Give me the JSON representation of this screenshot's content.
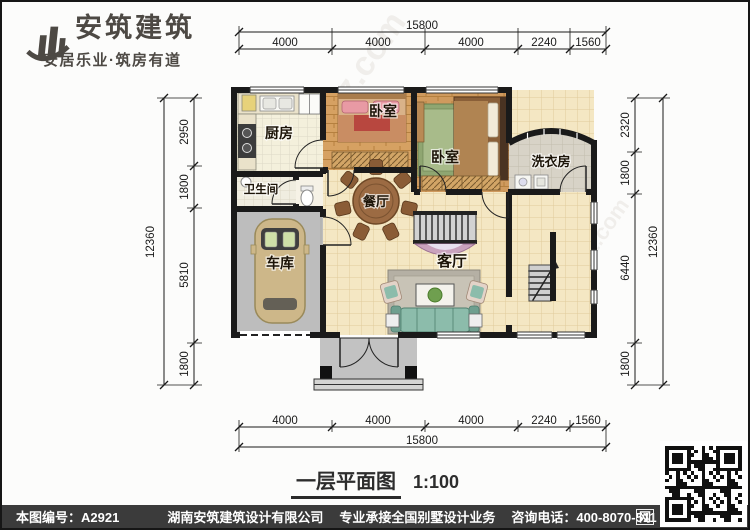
{
  "brand": {
    "logo_name": "安筑建筑",
    "tagline": "安居乐业·筑房有道"
  },
  "title": {
    "text": "一层平面图",
    "scale": "1:100"
  },
  "rooms": {
    "kitchen": "厨房",
    "bedroom_top": "卧室",
    "bedroom_right": "卧室",
    "laundry": "洗衣房",
    "bathroom": "卫生间",
    "dining": "餐厅",
    "garage": "车库",
    "living": "客厅"
  },
  "dimensions": {
    "top": {
      "total": "15800",
      "segments": [
        "4000",
        "4000",
        "4000",
        "2240",
        "1560"
      ]
    },
    "bottom": {
      "total": "15800",
      "segments": [
        "4000",
        "4000",
        "4000",
        "2240",
        "1560"
      ]
    },
    "left": {
      "total": "12360",
      "segments": [
        "2950",
        "1800",
        "5810",
        "1800"
      ]
    },
    "right": {
      "total": "12360",
      "segments": [
        "2320",
        "1800",
        "6440",
        "1800"
      ]
    }
  },
  "footer": {
    "drawing_no": "本图编号：A2921",
    "company": "湖南安筑建筑设计有限公司",
    "service": "专业承接全国别墅设计业务",
    "phone": "咨询电话：400-8070-511",
    "web_char": "网"
  },
  "watermark": {
    "site": "hnazjz.com",
    "brand": "安筑建筑"
  },
  "colors": {
    "footer_bg": "#3b3b3b",
    "wall": "#1a1a1a",
    "floor_tile": "#f4e7c3",
    "wood_floor": "#d6a162",
    "garage_floor": "#bdbdbd",
    "sofa": "#8cbcab"
  }
}
